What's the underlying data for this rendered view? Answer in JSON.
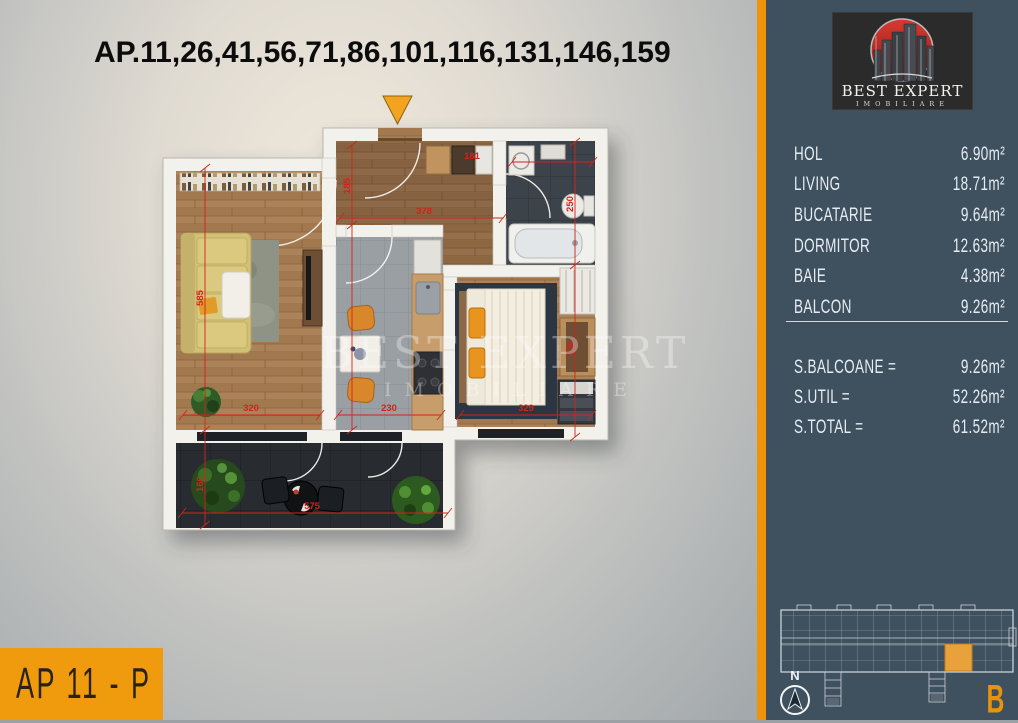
{
  "title": "AP.11,26,41,56,71,86,101,116,131,146,159",
  "apartment_label": "AP 11 - P",
  "watermark": {
    "line1": "BEST EXPERT",
    "line2": "IMOBILIARE"
  },
  "plan": {
    "dimensions": {
      "living_width": "320",
      "living_height": "585",
      "kitchen_width": "230",
      "hall_width": "378",
      "hall_height": "185",
      "bath_width": "181",
      "bath_height": "250",
      "bedroom_width": "329",
      "bedroom_height": "384",
      "balcony_width": "575",
      "balcony_height": "160"
    }
  },
  "panel": {
    "logo": {
      "brand": "BEST EXPERT",
      "sub": "IMOBILIARE"
    },
    "rooms": [
      {
        "label": "HOL",
        "area": "6.90m²"
      },
      {
        "label": "LIVING",
        "area": "18.71m²"
      },
      {
        "label": "BUCATARIE",
        "area": "9.64m²"
      },
      {
        "label": "DORMITOR",
        "area": "12.63m²"
      },
      {
        "label": "BAIE",
        "area": "4.38m²"
      },
      {
        "label": "BALCON",
        "area": "9.26m²"
      }
    ],
    "totals": [
      {
        "label": "S.BALCOANE =",
        "value": "9.26m²"
      },
      {
        "label": "S.UTIL =",
        "value": "52.26m²"
      },
      {
        "label": "S.TOTAL =",
        "value": "61.52m²"
      }
    ],
    "compass_label": "N",
    "section_letter": "B"
  },
  "colors": {
    "accent_orange": "#F09A0D",
    "dimension_red": "#D2231C",
    "panel_bg": "#3F505F",
    "logo_red": "#C42822"
  }
}
